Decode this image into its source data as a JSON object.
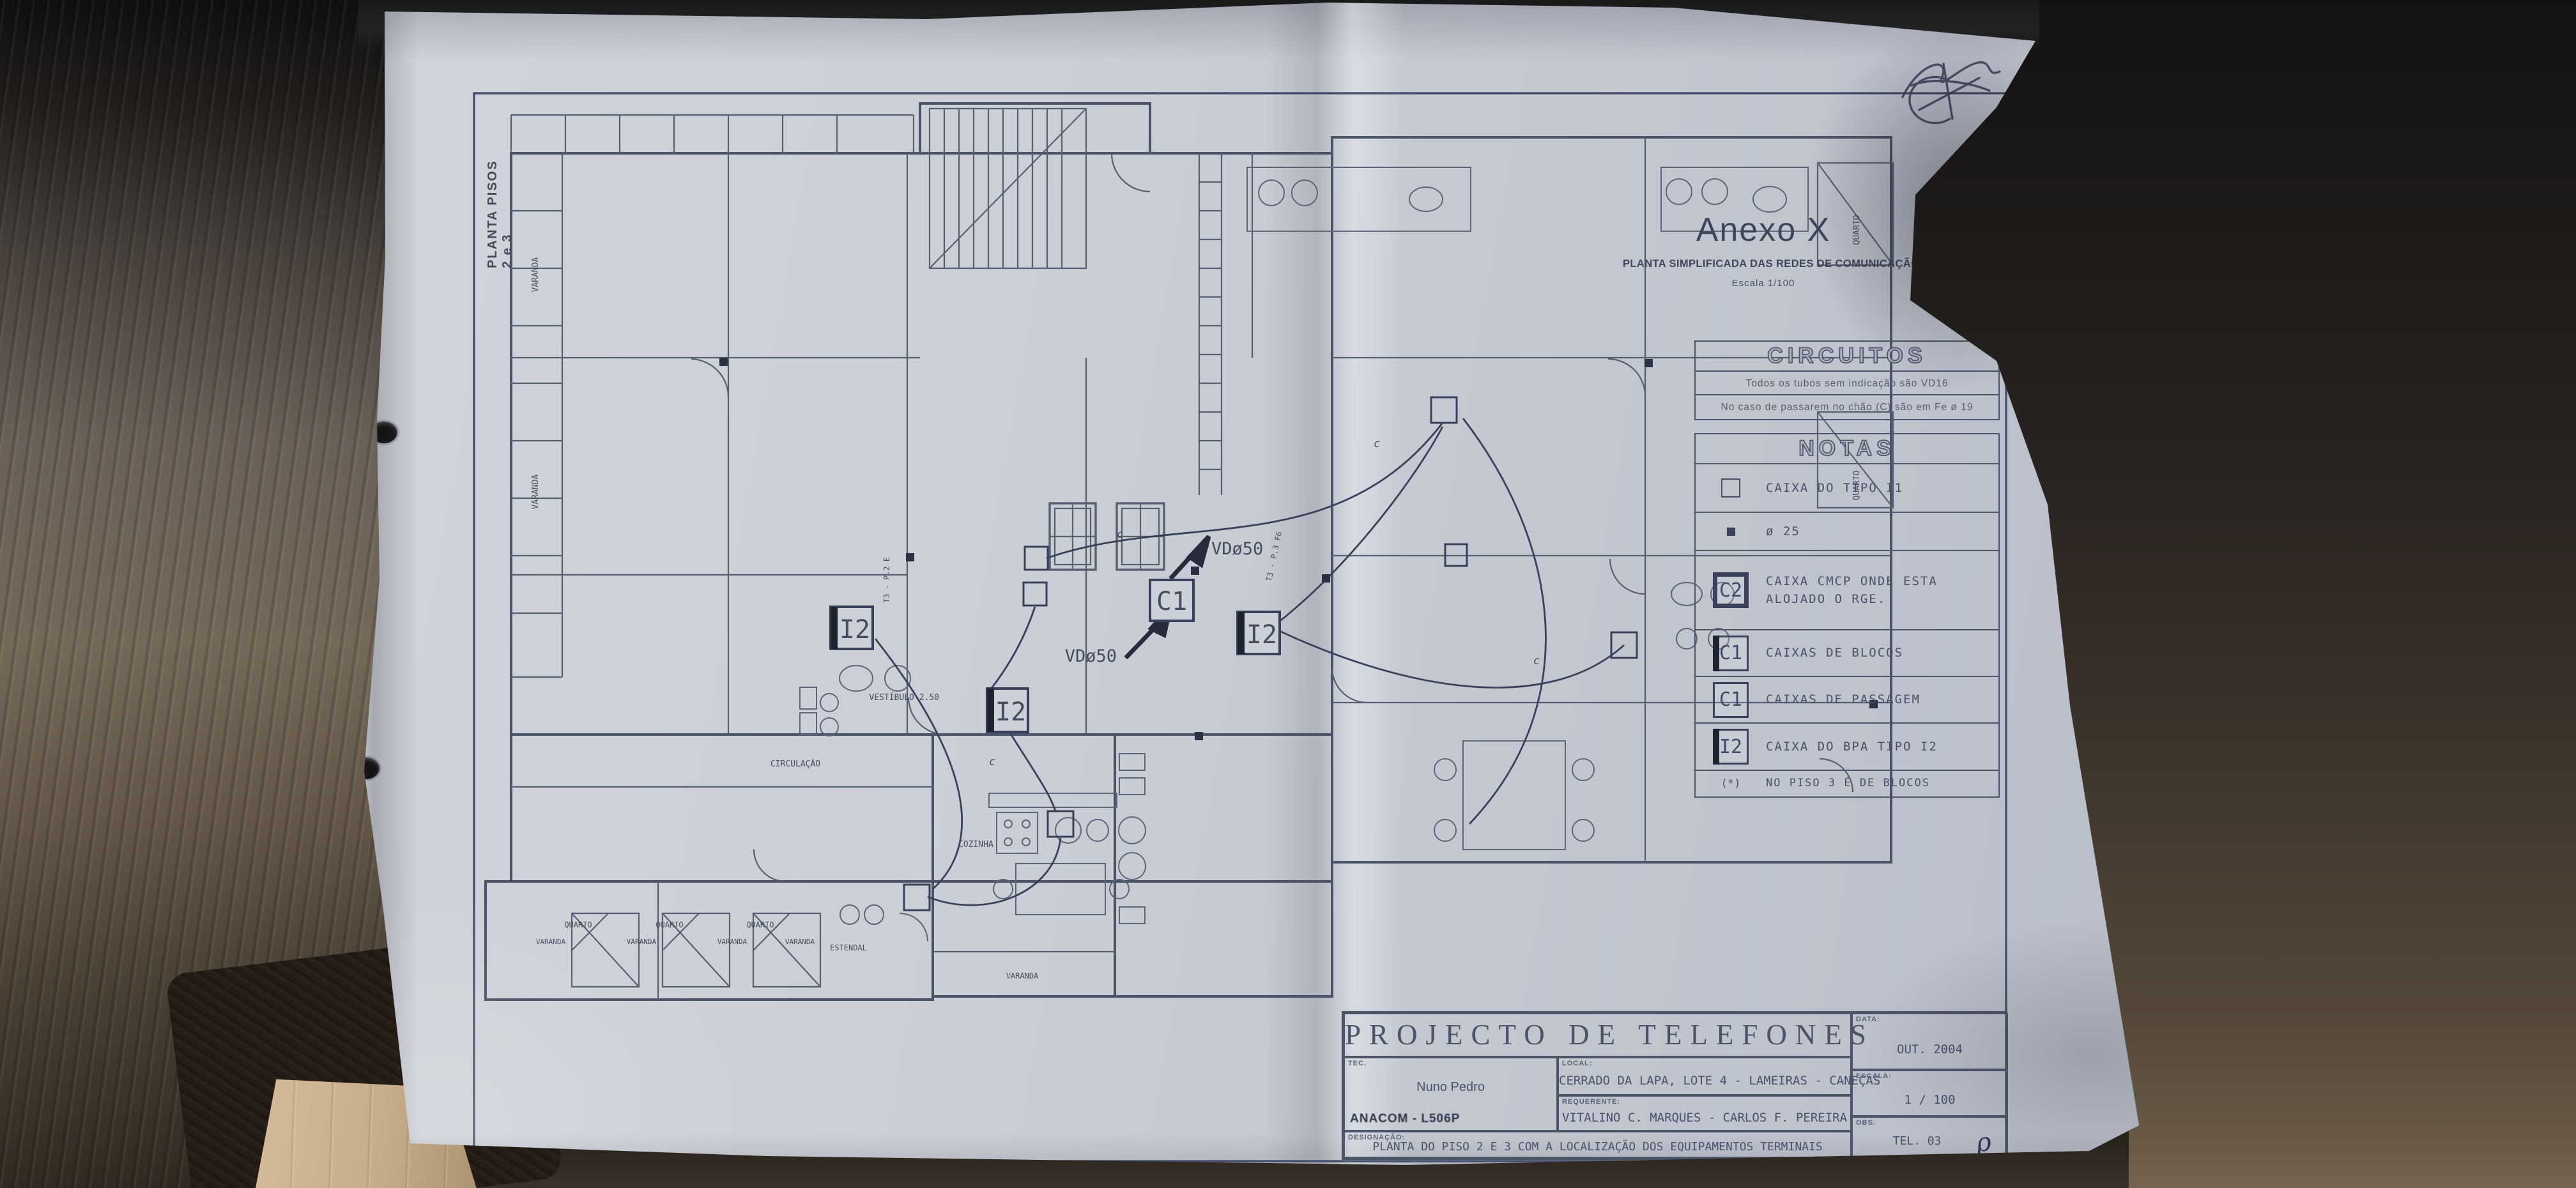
{
  "sheet": {
    "side_label": "PLANTA PISOS 2 e 3",
    "title": "Anexo X",
    "subtitle": "PLANTA SIMPLIFICADA DAS REDES DE COMUNICAÇÃO",
    "scale_note": "Escala 1/100"
  },
  "circuitos": {
    "title": "CIRCUITOS",
    "line1": "Todos os tubos sem indicação são VD16",
    "line2": "No caso de passarem no chão (C) são em Fe ø 19"
  },
  "notas": {
    "title": "NOTAS",
    "rows": [
      {
        "symbol": "square-outline-icon",
        "badge": "",
        "text": "CAIXA DO TIPO I1"
      },
      {
        "symbol": "square-filled-icon",
        "badge": "",
        "text": "ø 25"
      },
      {
        "symbol": "badge",
        "badge": "C2",
        "text": "CAIXA CMCP ONDE ESTA\nALOJADO O RGE."
      },
      {
        "symbol": "badge",
        "badge": "C1",
        "text": "CAIXAS DE BLOCOS"
      },
      {
        "symbol": "badge",
        "badge": "C1",
        "text": "CAIXAS DE PASSAGEM"
      },
      {
        "symbol": "badge",
        "badge": "I2",
        "text": "CAIXA DO BPA TIPO I2"
      },
      {
        "symbol": "note",
        "badge": "(*)",
        "text": "NO PISO 3 É DE BLOCOS"
      }
    ]
  },
  "titleblock": {
    "project": "PROJECTO DE TELEFONES",
    "tec_label": "TEC.",
    "tec_name": "Nuno Pedro",
    "tec_ref": "ANACOM - L506P",
    "local_label": "LOCAL:",
    "local_value": "CERRADO DA LAPA, LOTE 4 - LAMEIRAS - CANEÇAS",
    "requerente_label": "REQUERENTE:",
    "requerente_value": "VITALINO C. MARQUES - CARLOS F. PEREIRA",
    "designacao_label": "DESIGNAÇÃO:",
    "designacao_value": "PLANTA DO PISO 2 E 3 COM A LOCALIZAÇÃO DOS EQUIPAMENTOS TERMINAIS",
    "data_label": "DATA:",
    "data_value": "OUT. 2004",
    "escala_label": "ESCALA:",
    "escala_value": "1 / 100",
    "obs_label": "OBS.",
    "obs_value": "TEL. 03",
    "obs_mark": "ρ"
  },
  "plan": {
    "labels": [
      "VARANDA",
      "VARANDA",
      "CIRCULAÇÃO",
      "VESTÍBULO 2.50",
      "COZINHA",
      "ESTENDAL",
      "QUARTO",
      "QUARTO",
      "QUARTO",
      "VARANDA",
      "VARANDA",
      "VARANDA",
      "VARANDA",
      "QUARTO",
      "QUARTO",
      "T3 - P.2 E",
      "T3 - P.3 F6",
      "VDø50",
      "VDø50",
      "c",
      "c",
      "c",
      "c",
      "VARANDA"
    ],
    "badges": [
      "C1",
      "I2",
      "I2",
      "I2"
    ]
  },
  "colors": {
    "paper": "#c9cdd4",
    "ink": "#465062",
    "leather_dark": "#201d1b",
    "leather_brown": "#55483a",
    "leather_grey": "#6a6057",
    "beige_object": "#c6ad89"
  }
}
